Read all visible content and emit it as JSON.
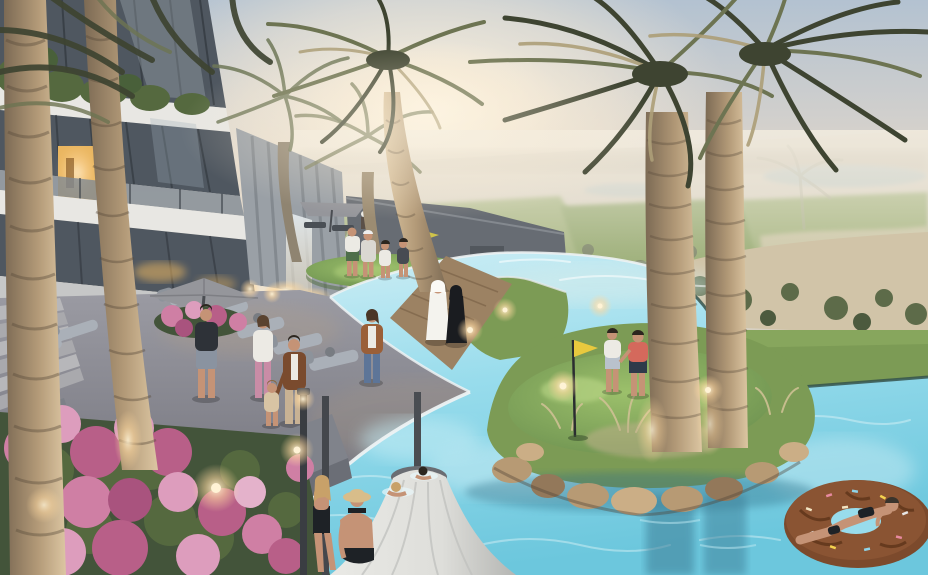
{
  "meta": {
    "alt": "Dusk rendering of a resort: apartment building with lit balconies at left, uplit palm trees, turquoise infinity pools wrapping putting-green islands with a yellow golf flag, sun loungers, pink flower planters, people strolling and swimming, a donut pool float, and a hazy golf course stretching to the horizon."
  },
  "palette": {
    "sky_top": "#b3c2d1",
    "sky_mid": "#ddd5cb",
    "sky_warm": "#f2e6d0",
    "sun_glow": "#fdf5e3",
    "haze": "#f2ecdf",
    "land_base": "#d6cfc1",
    "land_strip": "#b9b1a0",
    "fairway": "#93a86b",
    "fairway_dark": "#7f9a57",
    "sand": "#d1c4a8",
    "tree": "#5d6b49",
    "tree_dark": "#4c5a3e",
    "lake": "#b7c4c2",
    "pool_light": "#cfeef5",
    "pool_mid": "#98dcec",
    "pool_deep": "#6cc7dd",
    "pool_teal": "#57b5cf",
    "coping": "#edf2f3",
    "pool_edge_dark": "#35544c",
    "lawn": "#7c9b55",
    "green_lit": "#9cc06b",
    "green_mid": "#6d9150",
    "patio_light": "#9b9ba3",
    "patio_dark": "#686871",
    "step": "#b7b7ba",
    "wood": "#9c8263",
    "wood_dark": "#7c6448",
    "bldg_white": "#e8e7e3",
    "bldg_shadow": "#c6c7c7",
    "glass": "#4f5760",
    "glass_light": "#7f8a93",
    "mullion": "#31363c",
    "window_glow": "#eab660",
    "core": "#9aa0a6",
    "fin": "#7e848a",
    "terrace_wall": "#676c73",
    "foliage": "#55693f",
    "foliage_dark": "#43543a",
    "flower_a": "#cf7fa4",
    "flower_b": "#b85f88",
    "flower_c": "#dd9dbd",
    "flower_d": "#a9537e",
    "trunk_lit": "#dcc6a2",
    "trunk_mid": "#b39a78",
    "trunk_dark": "#7c6a54",
    "trunk_ring": "#584a3a",
    "frond_dark": "#3e4431",
    "frond_olive": "#6d7452",
    "frond_gold": "#ad9f78",
    "frond_haze": "#9aa187",
    "umbrella": "#95969b",
    "umbrella_closed": "#dededa",
    "umbrella_shade": "#b5b6b3",
    "pole": "#4a4d52",
    "lounger": "#aab0b8",
    "lounger_dark": "#8d939b",
    "stone": "#b79a74",
    "stone_dark": "#93785a",
    "stone_light": "#cbae86",
    "glow": "#ffd9a0",
    "glow_core": "#fff3d6",
    "skin": "#c59376",
    "hair_dark": "#2c261f",
    "hair_blonde": "#c8a169",
    "kandura": "#f4f3ee",
    "abaya": "#1a1c20",
    "coral": "#d4695c",
    "navy": "#2e3a4a",
    "denim": "#5d7598",
    "cardigan": "#9a5f38",
    "white_cloth": "#eceae4",
    "beige": "#c8b294",
    "brown_jacket": "#7a4b2e",
    "straw_hat": "#d8bd8a",
    "swim_black": "#1e2226",
    "float_brown": "#7c4a2c",
    "float_dark": "#5e3419",
    "reflect_teal": "#3d7e96",
    "flag_yellow": "#e8c93e"
  }
}
